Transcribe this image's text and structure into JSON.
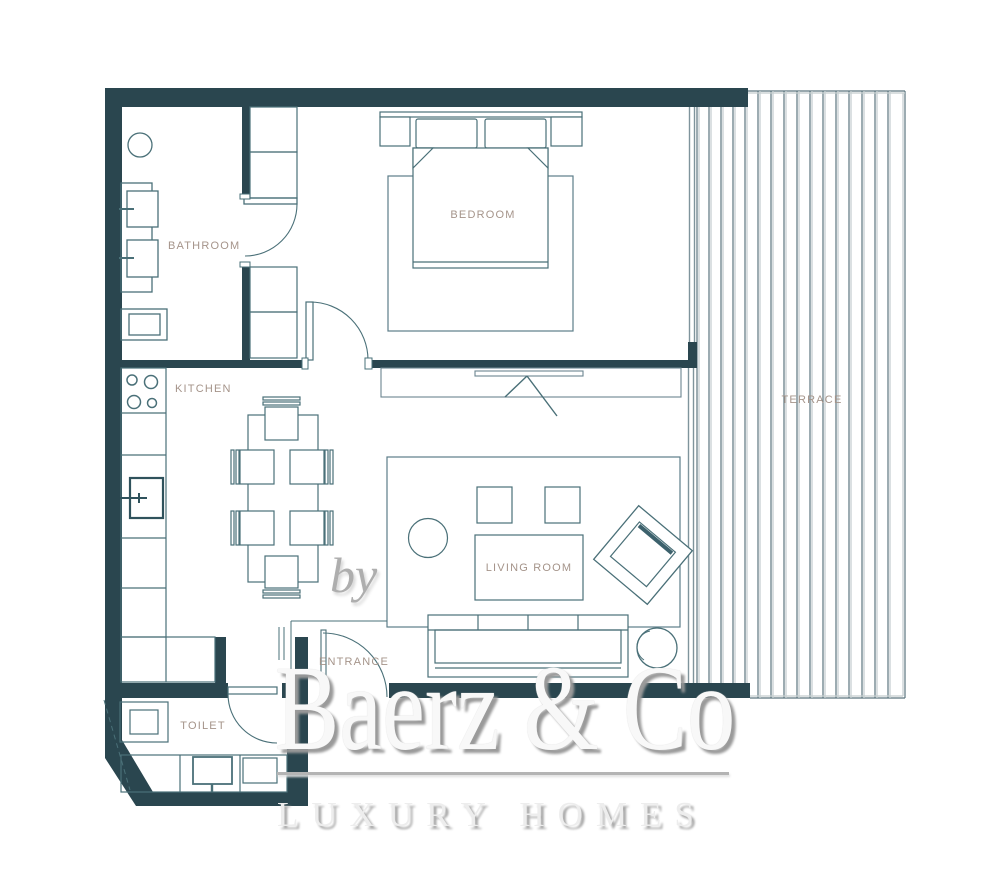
{
  "floorplan": {
    "rooms": {
      "bathroom": {
        "label": "BATHROOM"
      },
      "bedroom": {
        "label": "BEDROOM"
      },
      "kitchen": {
        "label": "KITCHEN"
      },
      "terrace": {
        "label": "TERRACE"
      },
      "living_room": {
        "label": "LIVING ROOM"
      },
      "entrance": {
        "label": "ENTRANCE"
      },
      "toilet": {
        "label": "TOILET"
      }
    },
    "colors": {
      "wall": "#2a464f",
      "furniture_line": "#4a7078",
      "room_label": "#a5948a",
      "terrace_board_dark": "#5c757e",
      "terrace_board_light": "#c3ccce"
    }
  },
  "watermark": {
    "by": "by",
    "brand": "Baerz & Co",
    "tagline": "LUXURY HOMES"
  }
}
